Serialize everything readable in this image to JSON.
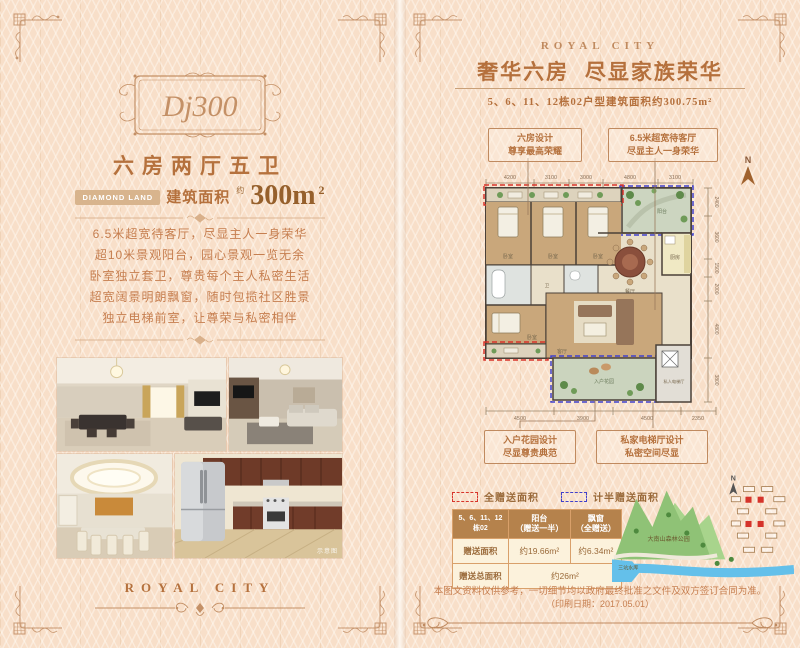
{
  "colors": {
    "accent": "#b5713d",
    "gift_red": "#d8342a",
    "gift_blue": "#4040cc"
  },
  "left": {
    "logo": "Dj300",
    "title": "六房两厅五卫",
    "brand_badge": "DIAMOND LAND",
    "area_label": "建筑面积",
    "approx": "约",
    "area_value": "300m",
    "area_exp": "2",
    "features": [
      "6.5米超宽待客厅，尽显主人一身荣华",
      "超10米景观阳台，园心景观一览无余",
      "卧室独立套卫，尊贵每个主人私密生活",
      "超宽阔景明朗飘窗，随时包揽社区胜景",
      "独立电梯前室，让尊荣与私密相伴"
    ],
    "photo_watermark": "示意图",
    "footer_brand": "ROYAL CITY"
  },
  "right": {
    "brand": "ROYAL CITY",
    "title": "奢华六房  尽显家族荣华",
    "subtitle": "5、6、11、12栋02户型建筑面积约300.75m²",
    "callouts": [
      {
        "line1": "六房设计",
        "line2": "尊享最高荣耀"
      },
      {
        "line1": "6.5米超宽待客厅",
        "line2": "尽显主人一身荣华"
      },
      {
        "line1": "入户花园设计",
        "line2": "尽显尊贵典范"
      },
      {
        "line1": "私家电梯厅设计",
        "line2": "私密空间尽显"
      }
    ],
    "north": "N",
    "dims_top": [
      "4200",
      "3100",
      "3000",
      "4800",
      "3100"
    ],
    "dims_bottom": [
      "4500",
      "3900",
      "4500",
      "2350"
    ],
    "dims_right": [
      "2400",
      "3600",
      "1500",
      "2000",
      "4800",
      "3800"
    ],
    "plan_labels": {
      "bedroom1": "卧室",
      "bedroom2": "卧室",
      "bedroom3": "卧室",
      "bedroom4": "卧室",
      "bath": "卫",
      "dining": "餐厅",
      "kitchen": "厨房",
      "living": "客厅",
      "terrace": "阳台",
      "garden": "入户花园",
      "elevator": "私人电梯厅"
    },
    "legend": [
      {
        "label": "全赠送面积"
      },
      {
        "label": "计半赠送面积"
      }
    ],
    "table": {
      "col0_header": "5、6、11、12栋02",
      "col1_header": "阳台\n（赠送一半）",
      "col2_header": "飘窗\n（全赠送）",
      "row1_label": "赠送面积",
      "row1_val1": "约19.66m²",
      "row1_val2": "约6.34m²",
      "row2_label": "赠送总面积",
      "row2_value": "约26m²"
    },
    "map": {
      "park": "大南山森林公园",
      "lake": "三坑水库",
      "north": "N"
    },
    "disclaimer1": "本图文资料仅供参考，一切细节均以政府最终批准之文件及双方签订合同为准。",
    "disclaimer2": "（印刷日期：2017.05.01）"
  }
}
